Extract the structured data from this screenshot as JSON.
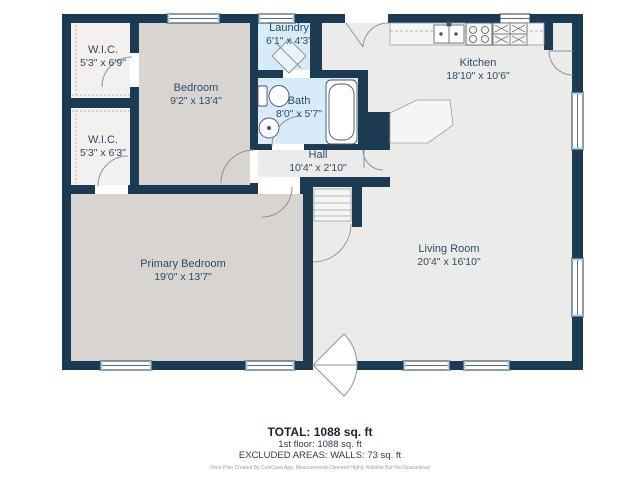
{
  "floorplan": {
    "title": "1st floor plan",
    "rooms": [
      {
        "id": "wic1",
        "name": "W.I.C.",
        "dims": "5'3\" x 6'9\""
      },
      {
        "id": "wic2",
        "name": "W.I.C.",
        "dims": "5'3\" x 6'3\""
      },
      {
        "id": "bedroom",
        "name": "Bedroom",
        "dims": "9'2\" x 13'4\""
      },
      {
        "id": "laundry",
        "name": "Laundry",
        "dims": "6'1\" x 4'3\""
      },
      {
        "id": "bath",
        "name": "Bath",
        "dims": "8'0\" x 5'7\""
      },
      {
        "id": "hall",
        "name": "Hall",
        "dims": "10'4\" x 2'10\""
      },
      {
        "id": "kitchen",
        "name": "Kitchen",
        "dims": "18'10\" x 10'6\""
      },
      {
        "id": "living_room",
        "name": "Living Room",
        "dims": "20'4\" x 16'10\""
      },
      {
        "id": "primary_bedroom",
        "name": "Primary Bedroom",
        "dims": "19'0\" x 13'7\""
      }
    ],
    "colors": {
      "wall": "#1c3a52",
      "room_gray": "#d8d5d0",
      "room_light": "#ebebe9",
      "room_blue": "#d7ebf9",
      "room_wic": "#f2f1ef",
      "label_text": "#2e4b66",
      "fixture_line": "#8e9399"
    },
    "footer": {
      "total": "TOTAL: 1088 sq. ft",
      "floor": "1st floor: 1088 sq. ft",
      "excluded": "EXCLUDED AREAS: WALLS: 73 sq. ft",
      "disclaimer": "Floor Plan Created By CubiCasa App. Measurements Deemed Highly Reliable But Not Guaranteed"
    }
  }
}
